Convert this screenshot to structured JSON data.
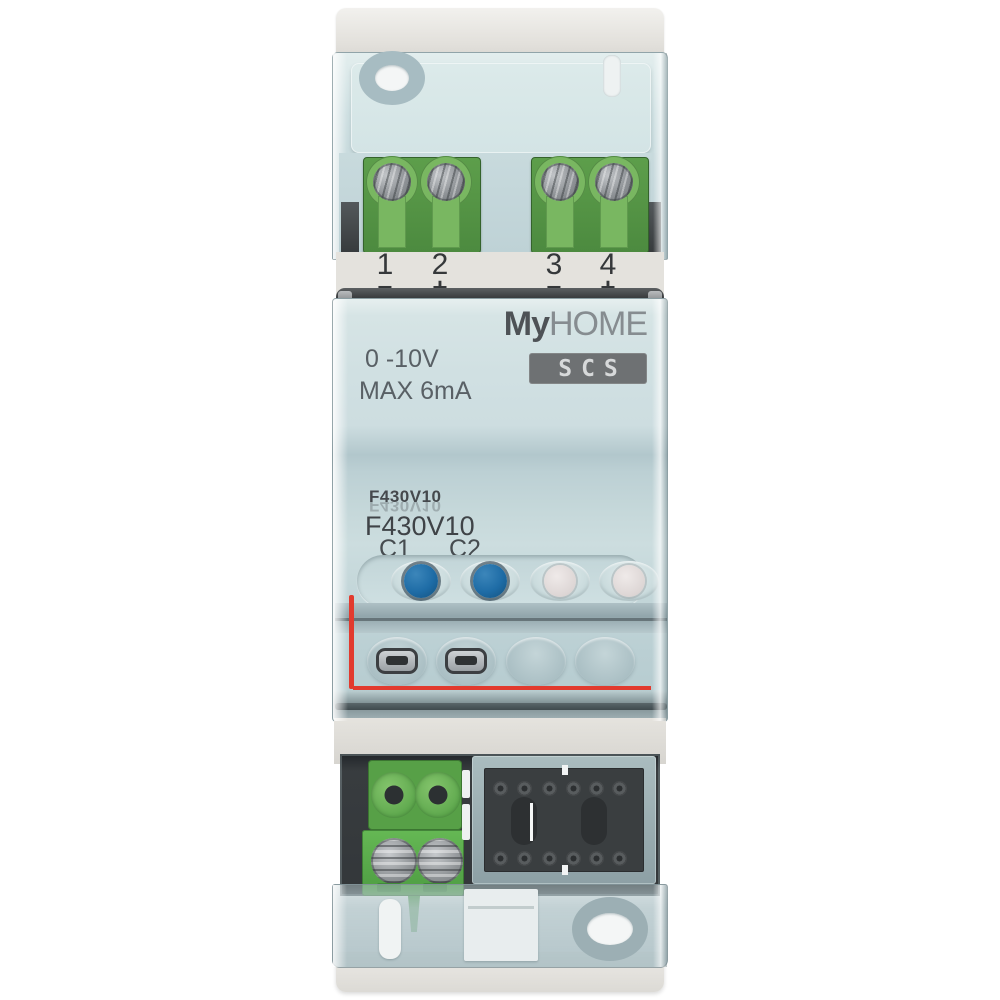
{
  "product": {
    "brand_bold": "My",
    "brand_rest": "HOME",
    "bus_label": "SCS",
    "voltage_spec": "0 -10V",
    "current_spec": "MAX 6mA",
    "model_print_small": "F430V10",
    "model_print_small_reflection": "F430V10",
    "model_print_large": "F430V10",
    "channel_1": "C1",
    "channel_2": "C2"
  },
  "terminal_strip": {
    "numbers": [
      "1",
      "2",
      "3",
      "4"
    ],
    "polarities": [
      "−",
      "+",
      "−",
      "+"
    ]
  },
  "colors": {
    "housing_green": "#5CB04C",
    "button_blue": "#1E6CA6",
    "seal_red": "#E2342B",
    "cover_tint": "#CDDFE1",
    "scs_badge_gray": "#6E7173",
    "print_text_gray": "#45494D"
  }
}
